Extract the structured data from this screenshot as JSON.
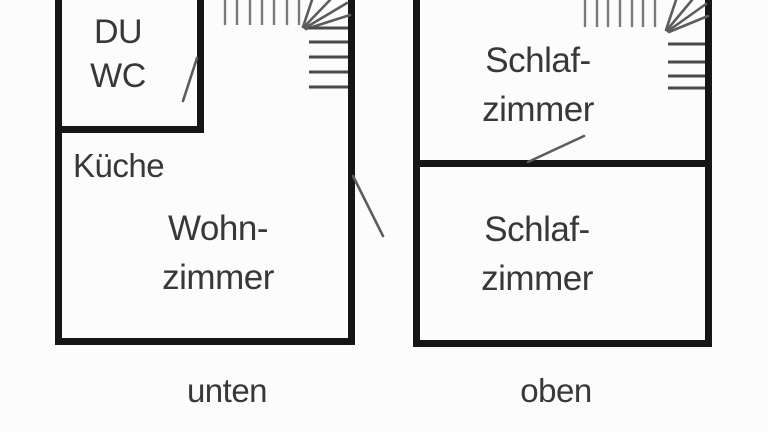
{
  "meta": {
    "type": "floor-plan-diagram",
    "language": "de"
  },
  "colors": {
    "background": "#fcfcfc",
    "wall": "#161616",
    "text": "#383838",
    "stair_line": "#7a7a7a",
    "stair_tread": "#4a4a4a",
    "door_line": "#5c5c5c"
  },
  "plans": {
    "lower": {
      "caption": "unten",
      "rooms": [
        {
          "id": "du-wc",
          "lines": [
            "DU",
            "WC"
          ]
        },
        {
          "id": "kueche",
          "lines": [
            "Küche"
          ]
        },
        {
          "id": "wohnzimmer",
          "lines": [
            "Wohn-",
            "zimmer"
          ]
        }
      ],
      "features": [
        "winder-staircase",
        "du-wc-door",
        "entrance-door"
      ]
    },
    "upper": {
      "caption": "oben",
      "rooms": [
        {
          "id": "schlafzimmer-oben-1",
          "lines": [
            "Schlaf-",
            "zimmer"
          ]
        },
        {
          "id": "schlafzimmer-oben-2",
          "lines": [
            "Schlaf-",
            "zimmer"
          ]
        }
      ],
      "features": [
        "winder-staircase",
        "bedroom-door"
      ]
    }
  }
}
